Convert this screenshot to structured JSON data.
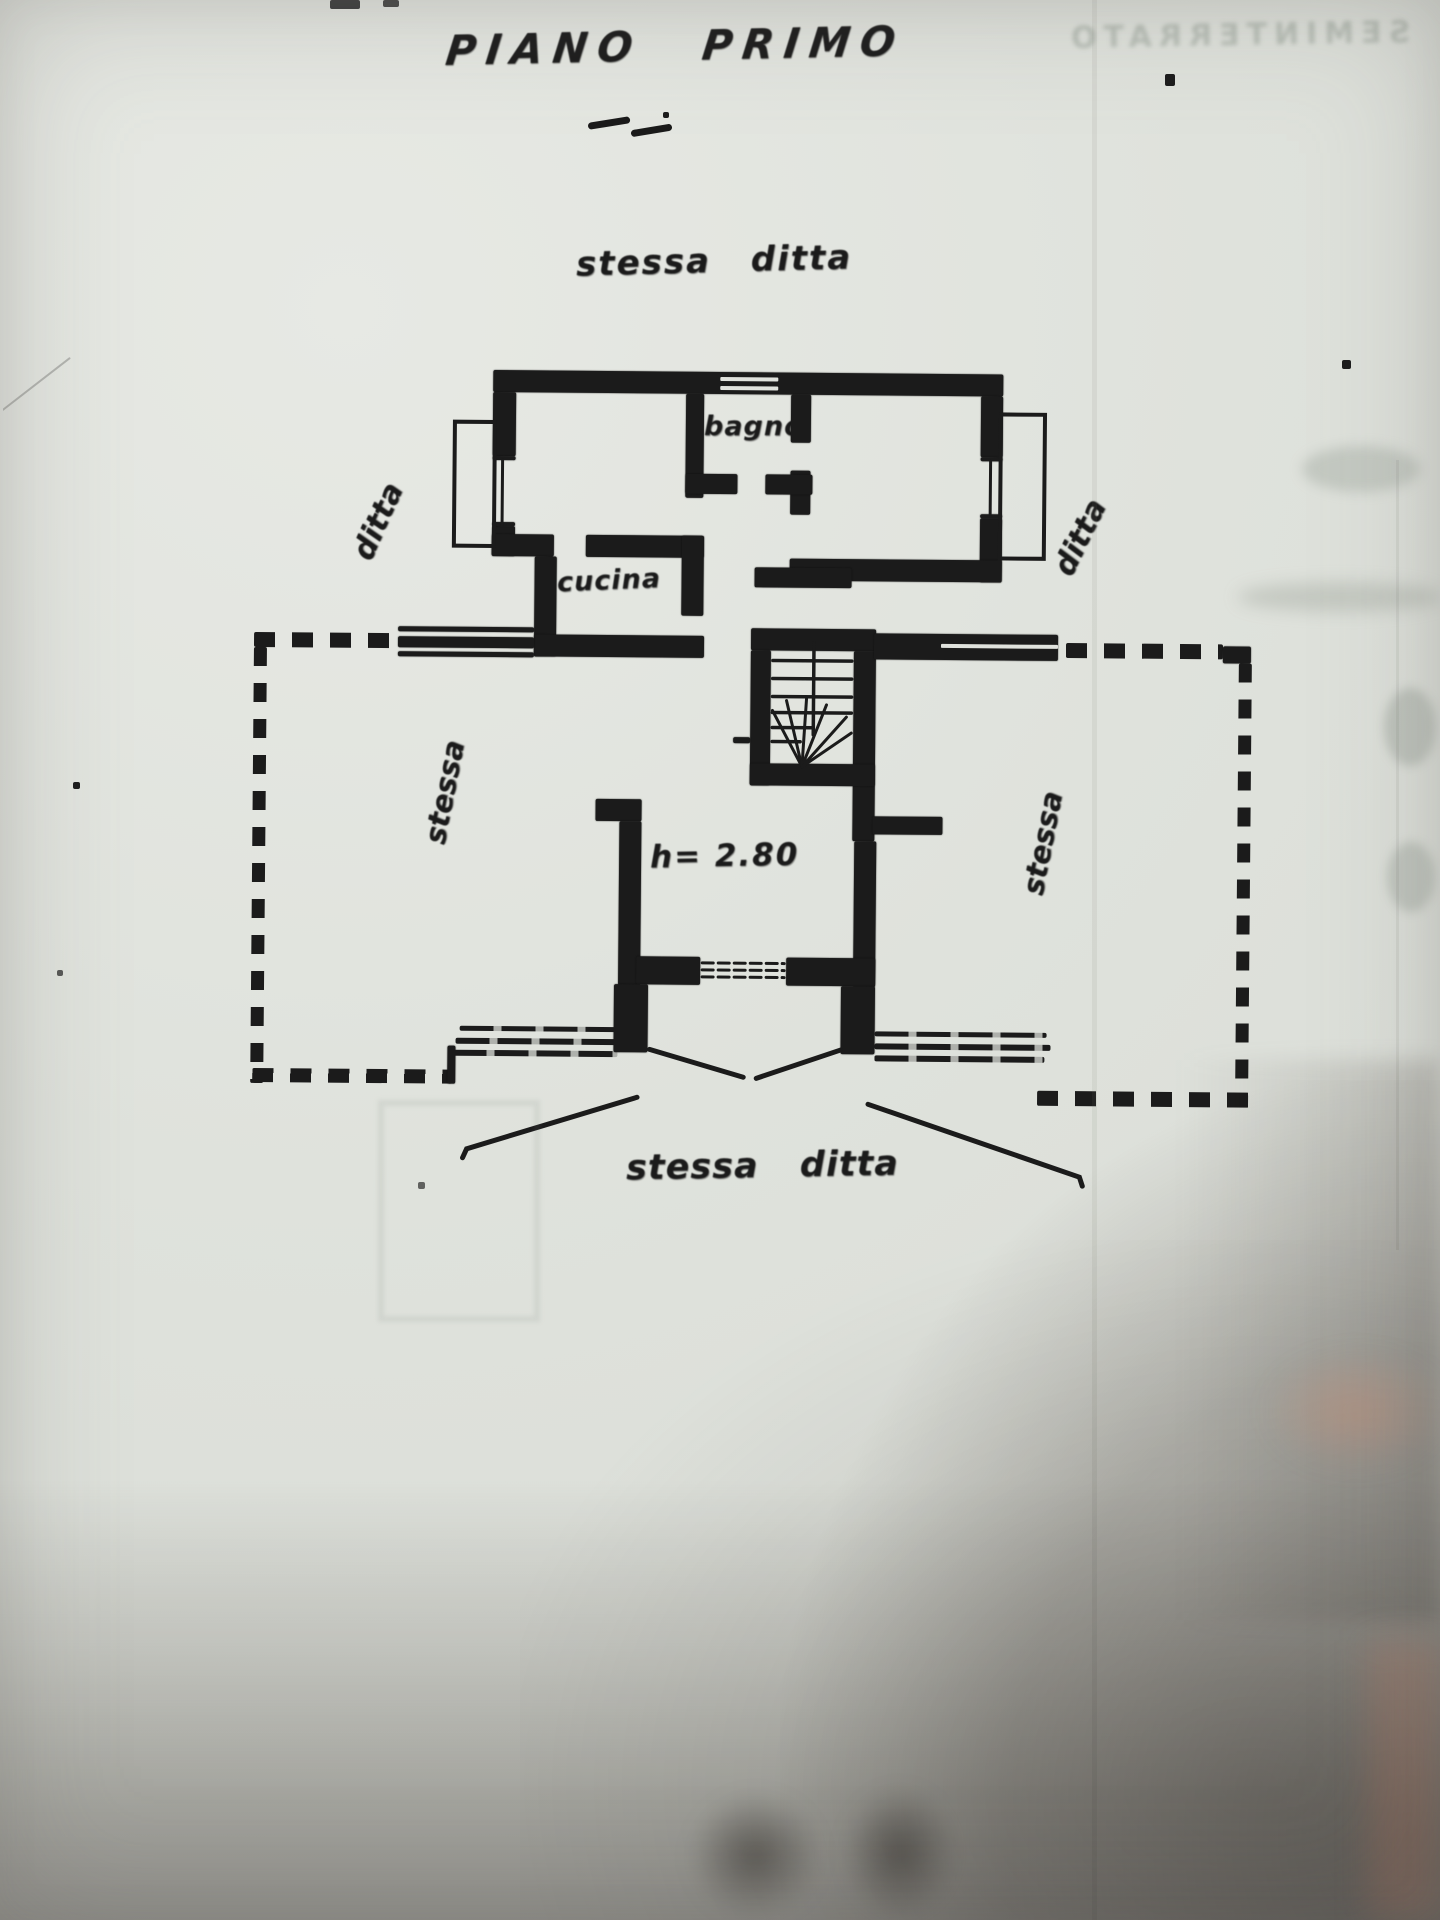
{
  "document": {
    "title": "PIANO PRIMO",
    "labels": {
      "neighbor_top": "stessa ditta",
      "neighbor_bottom": "stessa ditta",
      "side_left": "ditta",
      "side_right": "ditta",
      "room_left": "stessa",
      "room_right": "stessa",
      "bathroom": "bagno",
      "kitchen": "cucina",
      "ceiling_height": "h= 2.80"
    },
    "bleed_through": {
      "top_right_mirrored": "SEMINTERRATO"
    },
    "colors": {
      "paper": "#e0e2dd",
      "ink": "#1b1b1b",
      "bleed_text": "#94a094",
      "shadow": "#6e6660",
      "warm_shadow": "#c98b72"
    }
  }
}
